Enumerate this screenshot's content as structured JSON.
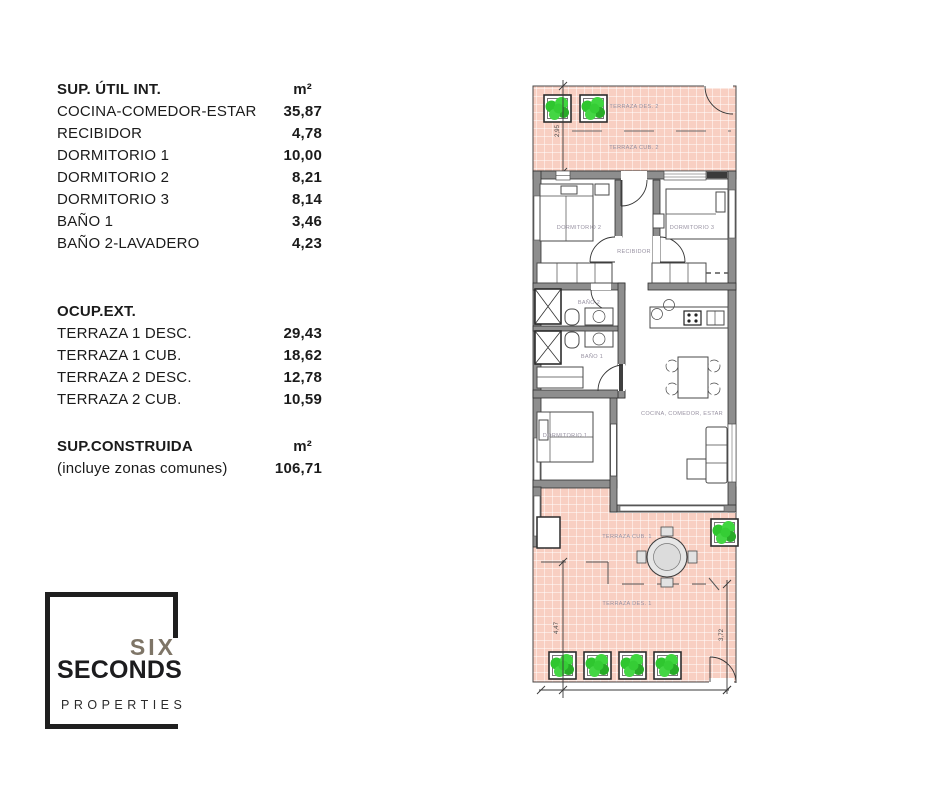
{
  "tables": {
    "sup_util": {
      "title": "SUP. ÚTIL INT.",
      "unit": "m²",
      "rows": [
        {
          "label": "COCINA-COMEDOR-ESTAR",
          "value": "35,87"
        },
        {
          "label": "RECIBIDOR",
          "value": "4,78"
        },
        {
          "label": "DORMITORIO 1",
          "value": "10,00"
        },
        {
          "label": "DORMITORIO 2",
          "value": "8,21"
        },
        {
          "label": "DORMITORIO 3",
          "value": "8,14"
        },
        {
          "label": "BAÑO 1",
          "value": "3,46"
        },
        {
          "label": "BAÑO 2-LAVADERO",
          "value": "4,23"
        }
      ]
    },
    "ocup_ext": {
      "title": "OCUP.EXT.",
      "unit": "",
      "rows": [
        {
          "label": "TERRAZA 1 DESC.",
          "value": "29,43"
        },
        {
          "label": "TERRAZA 1 CUB.",
          "value": "18,62"
        },
        {
          "label": "TERRAZA 2 DESC.",
          "value": "12,78"
        },
        {
          "label": "TERRAZA 2 CUB.",
          "value": "10,59"
        }
      ]
    },
    "sup_construida": {
      "title": "SUP.CONSTRUIDA",
      "unit": "m²",
      "rows": [
        {
          "label": "(incluye zonas comunes)",
          "value": "106,71"
        }
      ]
    }
  },
  "logo": {
    "six": "SIX",
    "seconds": "SECONDS",
    "properties": "PROPERTIES",
    "accent_color": "#7e7567",
    "dark_color": "#1f1f1f"
  },
  "floorplan": {
    "labels": {
      "terraza_des_2": "TERRAZA DES. 2",
      "terraza_cub_2": "TERRAZA CUB. 2",
      "dormitorio_2": "DORMITORIO 2",
      "dormitorio_3": "DORMITORIO 3",
      "recibidor": "RECIBIDOR",
      "bano_2": "BAÑO 2",
      "bano_1": "BAÑO 1",
      "dormitorio_1": "DORMITORIO 1",
      "cocina_comedor_estar": "COCINA, COMEDOR, ESTAR",
      "terraza_cub_1": "TERRAZA CUB. 1",
      "terraza_des_1": "TERRAZA DES. 1"
    },
    "dimensions": {
      "terraza_2_depth": "2,95",
      "terraza_1_left": "4,47",
      "terraza_1_right": "3,72"
    },
    "colors": {
      "tile": "#f8cfc2",
      "wall": "#8e8e8e",
      "plant": "#2fc62f",
      "room_label": "#9892a2"
    }
  }
}
